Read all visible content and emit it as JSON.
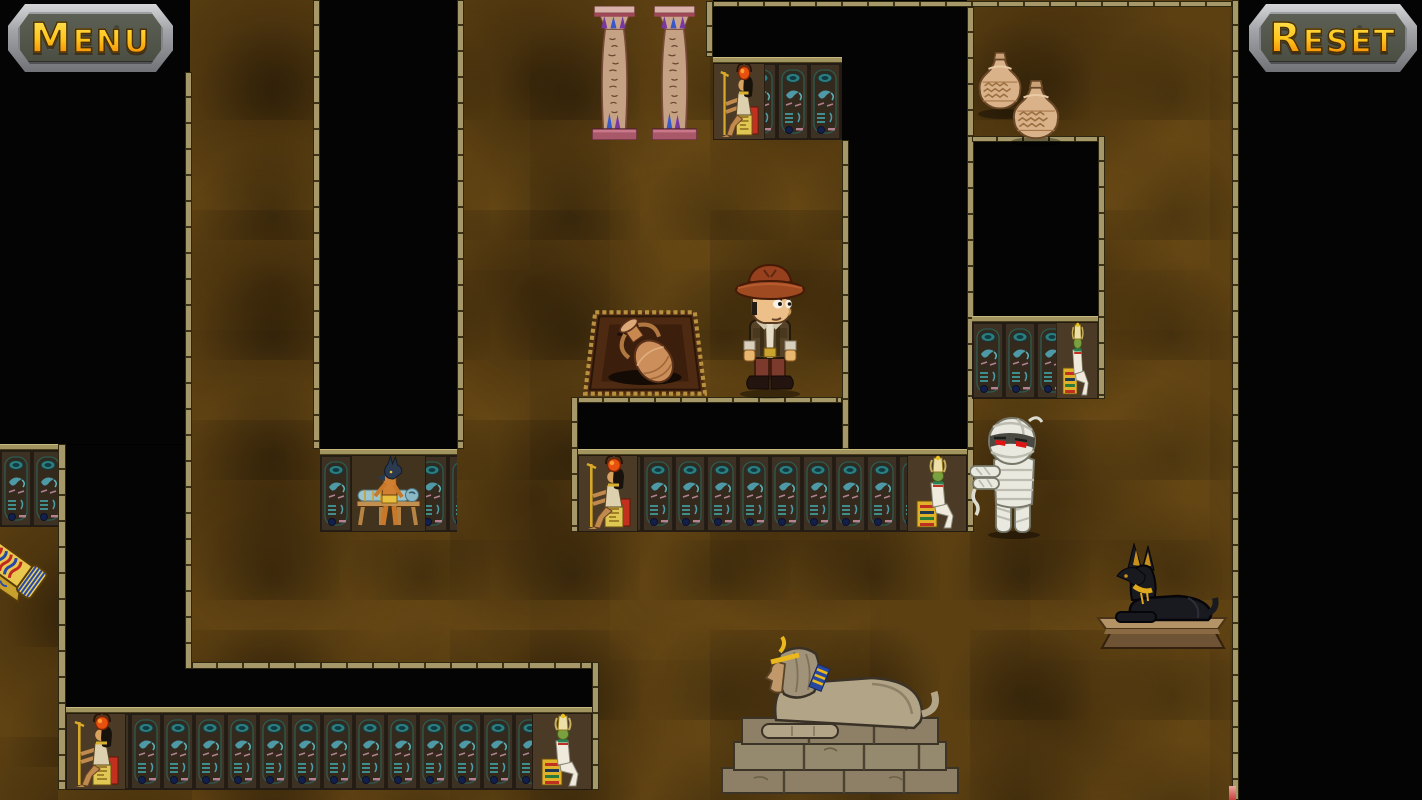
{
  "window": {
    "width": 1422,
    "height": 800
  },
  "hud": {
    "menu_button_label": "Menu",
    "reset_button_label": "Reset"
  },
  "scene": {
    "theme": "egyptian-tomb-maze",
    "colors": {
      "floor_brown": "#5c4012",
      "wall_black": "#040404",
      "wall_border_tan": "#a69868",
      "panel_glyph_teal": "#4d9aa6",
      "button_metal_gray": "#a2a3a7",
      "button_text_top": "#ffe95e",
      "button_text_bottom": "#e86d00",
      "mummy_eyes_red": "#e01414"
    },
    "entities": {
      "column_left": {
        "x": 592,
        "y": 6,
        "w": 45,
        "h": 134
      },
      "column_right": {
        "x": 652,
        "y": 6,
        "w": 45,
        "h": 134
      },
      "treasure_rug": {
        "x": 583,
        "y": 306,
        "w": 124,
        "h": 94
      },
      "explorer": {
        "x": 722,
        "y": 262,
        "w": 96,
        "h": 138
      },
      "mummy": {
        "x": 970,
        "y": 414,
        "w": 88,
        "h": 126
      },
      "vase_pair": {
        "x": 972,
        "y": 50,
        "w": 92,
        "h": 96
      },
      "anubis_statue": {
        "x": 1092,
        "y": 534,
        "w": 142,
        "h": 118
      },
      "sphinx": {
        "x": 714,
        "y": 628,
        "w": 252,
        "h": 168
      },
      "sarcophagus_lid": {
        "x": -14,
        "y": 520,
        "w": 84,
        "h": 84
      },
      "red_fragment": {
        "x": 1229,
        "y": 786,
        "w": 7,
        "h": 14
      },
      "menu_button": {
        "x": 8,
        "y": 4,
        "w": 165,
        "h": 68
      },
      "reset_button": {
        "x": 1249,
        "y": 4,
        "w": 168,
        "h": 68
      }
    }
  }
}
